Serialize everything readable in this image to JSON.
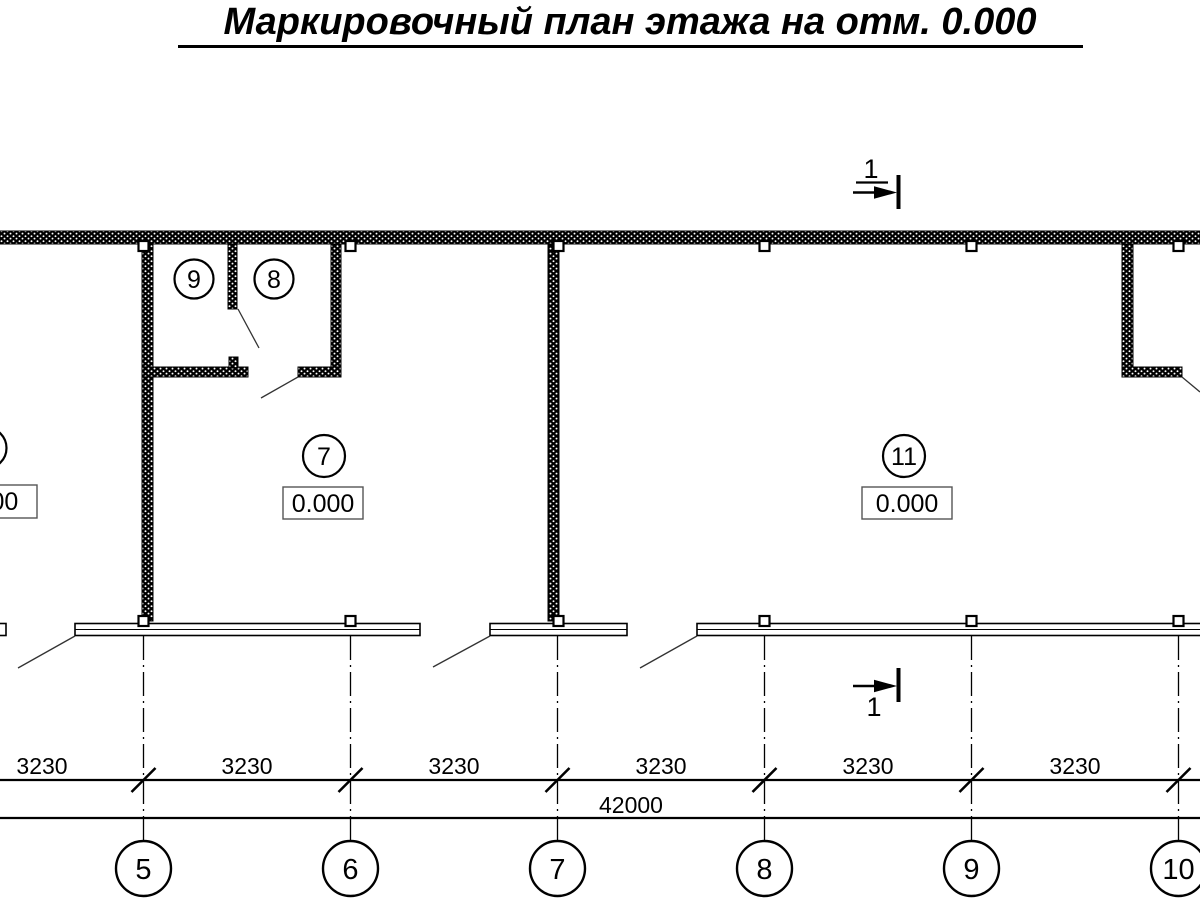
{
  "title": "Маркировочный план этажа на отм. 0.000",
  "sections": {
    "top": "1",
    "bottom": "1"
  },
  "rooms": {
    "room9": {
      "number": "9"
    },
    "room8": {
      "number": "8"
    },
    "room7": {
      "number": "7",
      "elevation": "0.000"
    },
    "room11": {
      "number": "11",
      "elevation": "0.000"
    },
    "room_left_clipped": {
      "elevation": "0.000"
    }
  },
  "dimensions": {
    "segments": [
      "3230",
      "3230",
      "3230",
      "3230",
      "3230",
      "3230"
    ],
    "total": "42000"
  },
  "axes": [
    "5",
    "6",
    "7",
    "8",
    "9",
    "10"
  ],
  "colors": {
    "ink": "#000000",
    "paper": "#ffffff"
  }
}
